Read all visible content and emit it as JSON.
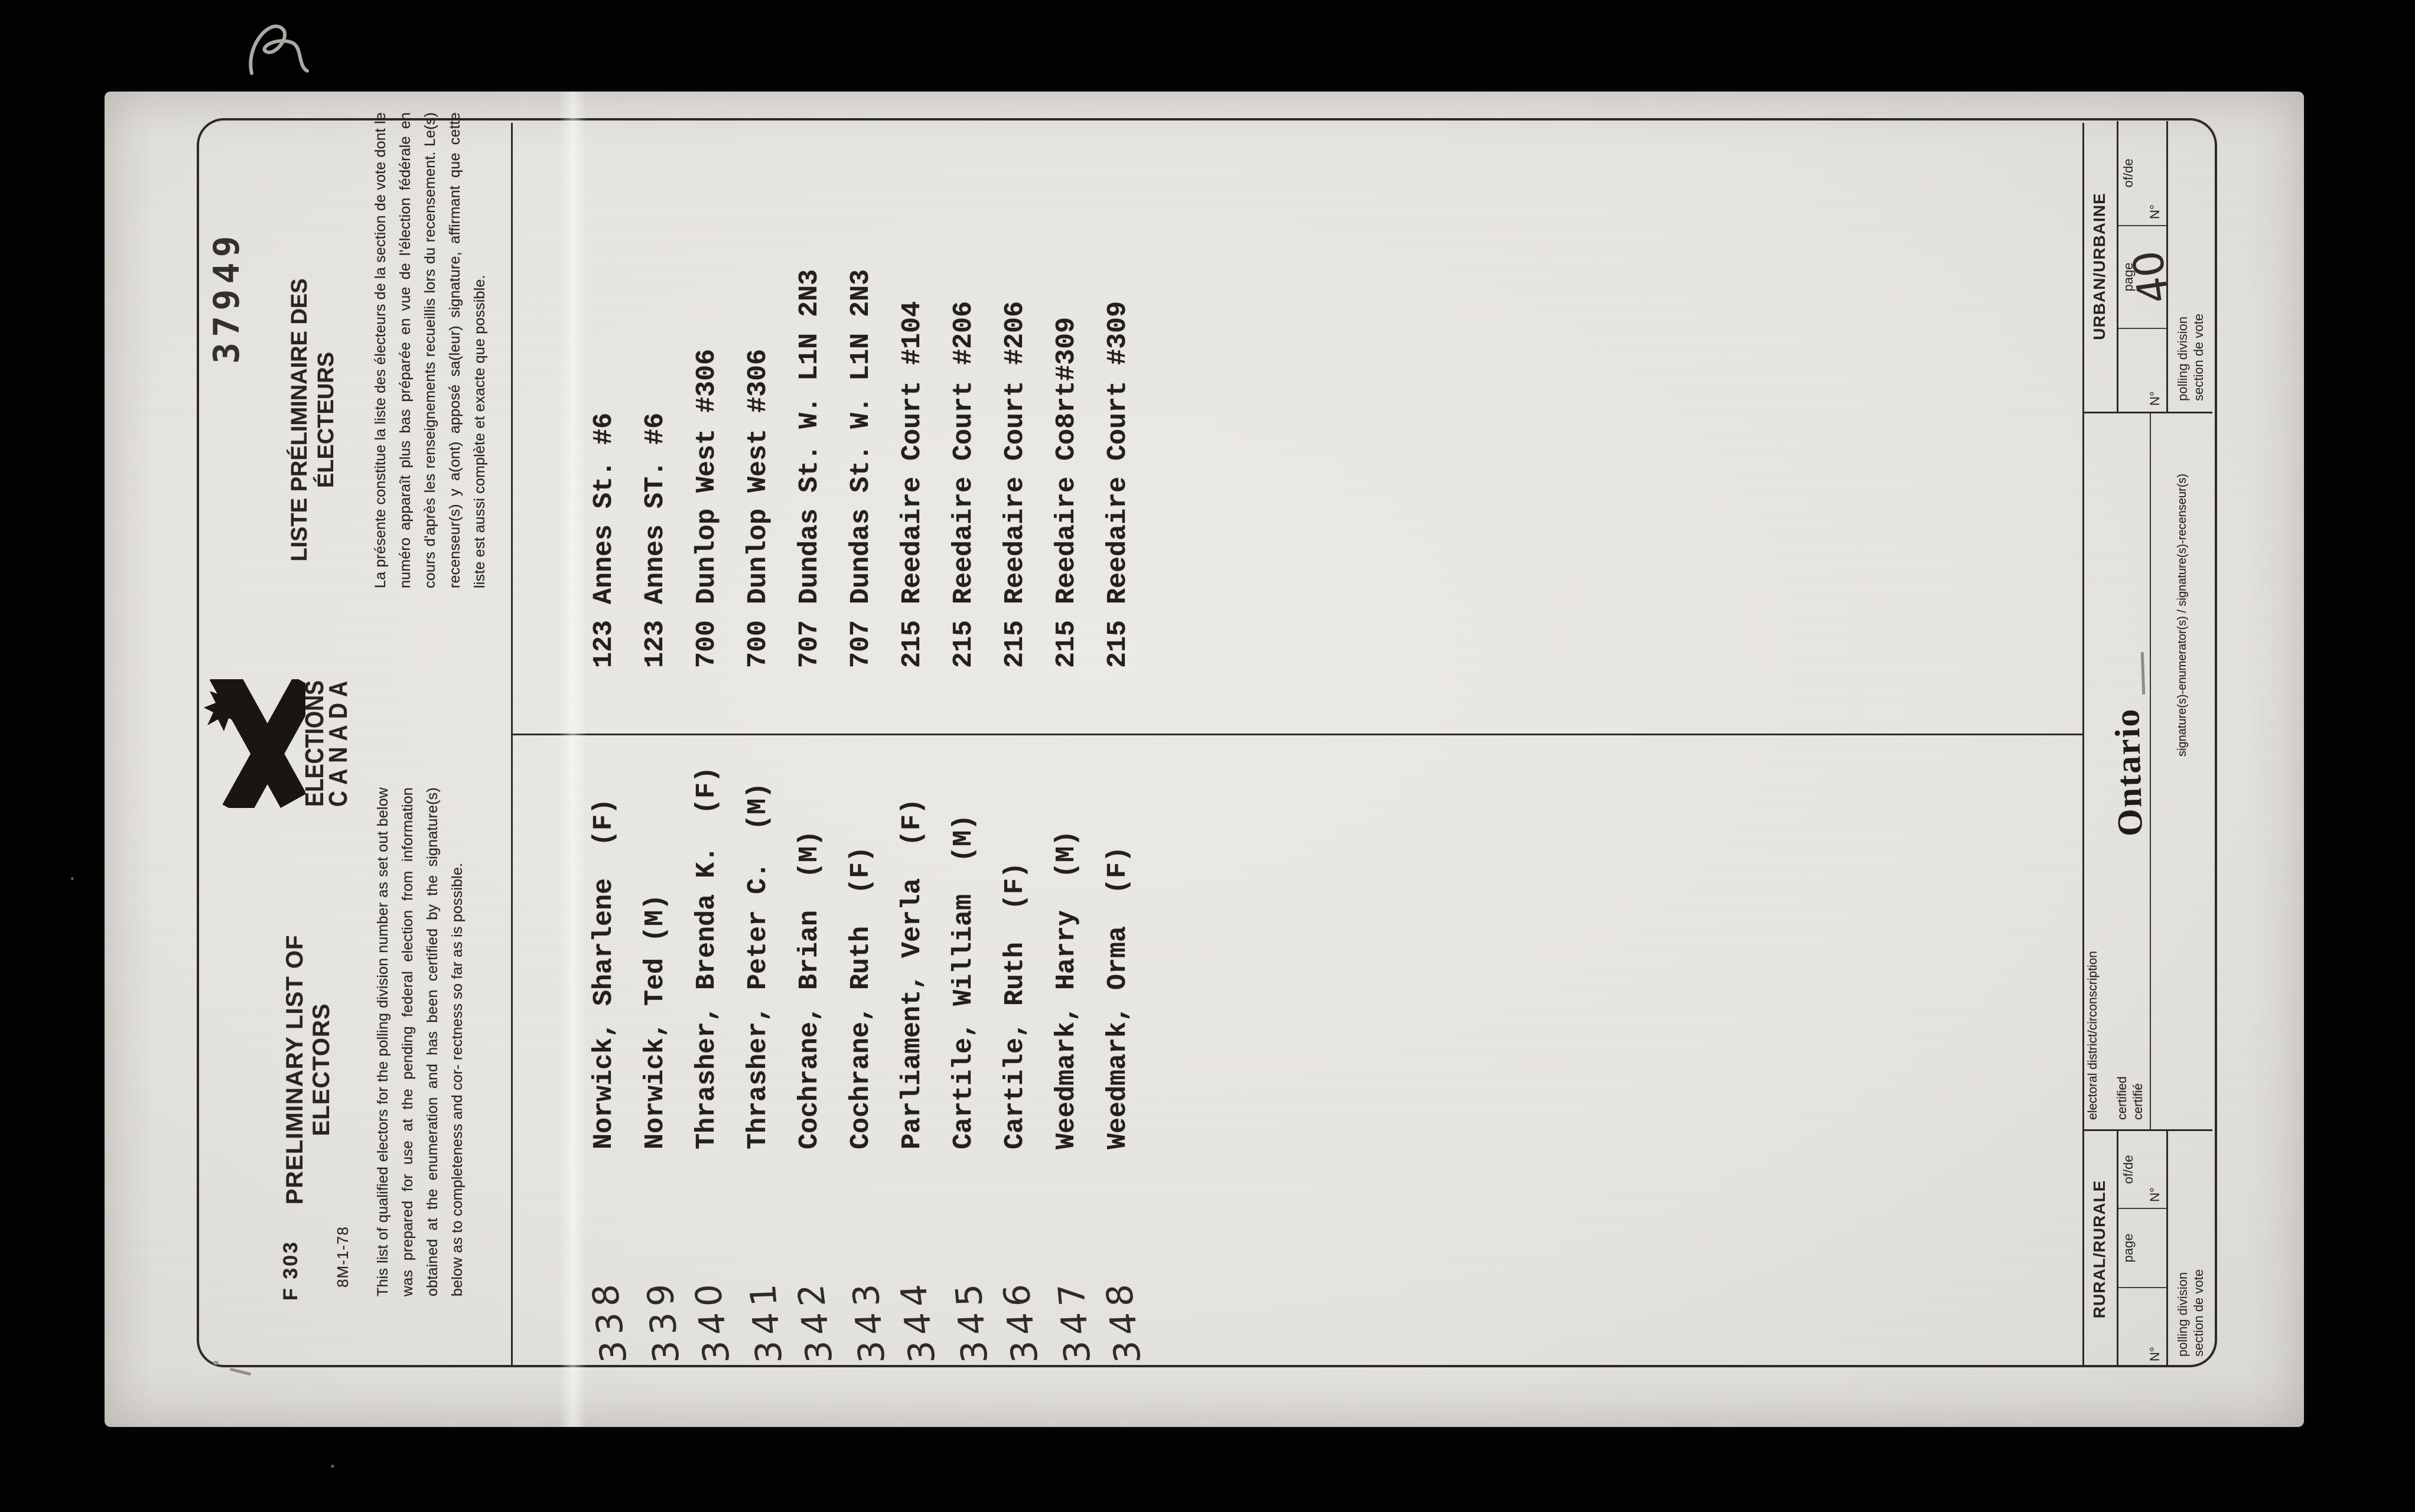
{
  "document": {
    "stamp_number": "37949",
    "header": {
      "form_number": "F 303",
      "print_code": "8M-1-78",
      "title_en": [
        "PRELIMINARY LIST OF",
        "ELECTORS"
      ],
      "title_fr": [
        "LISTE PRÉLIMINAIRE DES",
        "ÉLECTEURS"
      ],
      "paragraph_en": "This list of qualified electors for the polling division number as set out below was prepared for use at the pending federal election from information obtained at the enumeration and has been certified by the signature(s) below as to completeness and cor- rectness so far as is possible.",
      "paragraph_fr": "La présente constitue la liste des électeurs de la section de vote dont le numéro apparaît plus bas préparée en vue de l'élection fédérale en cours d'après les renseignements recueillis lors du recensement. Le(s) recenseur(s) y a(ont) apposé sa(leur) signature, affirmant que cette liste est aussi complète et exacte que possible.",
      "logo_wordmark": [
        "ELECTIONS",
        "CANADA"
      ]
    },
    "electors": [
      {
        "no": "338",
        "name": "Norwick, Sharlene  (F)",
        "address": "123 Annes St. #6"
      },
      {
        "no": "339",
        "name": "Norwick, Ted (M)",
        "address": "123 Annes ST. #6"
      },
      {
        "no": "340",
        "name": "Thrasher, Brenda K.  (F)",
        "address": "700 Dunlop West #306"
      },
      {
        "no": "341",
        "name": "Thrasher, Peter C.  (M)",
        "address": "700 Dunlop West #306"
      },
      {
        "no": "342",
        "name": "Cochrane, Brian  (M)",
        "address": "707 Dundas St. W. L1N 2N3"
      },
      {
        "no": "343",
        "name": "Cochrane, Ruth  (F)",
        "address": "707 Dundas St. W. L1N 2N3"
      },
      {
        "no": "344",
        "name": "Parliament, Verla  (F)",
        "address": "215 Reedaire Court #104"
      },
      {
        "no": "345",
        "name": "Cartile, William  (M)",
        "address": "215 Reedaire Court #206"
      },
      {
        "no": "346",
        "name": "Cartile, Ruth  (F)",
        "address": "215 Reedaire Court #206"
      },
      {
        "no": "347",
        "name": "Weedmark, Harry  (M)",
        "address": "215 Reedaire Co8rt#309"
      },
      {
        "no": "348",
        "name": "Weedmark, Orma  (F)",
        "address": "215 Reedaire Court #309"
      }
    ],
    "footer": {
      "urban_label": "URBAN/URBAINE",
      "rural_label": "RURAL/RURALE",
      "no_label": "N°",
      "page_label": "page",
      "ofde_label": "of/de",
      "polling_line1": "polling division",
      "polling_line2": "section de vote",
      "district_label": "electoral district/circonscription",
      "certified_en": "certified",
      "certified_fr": "certifié",
      "signature_label": "signature(s)-enumerator(s) / signature(s)-recenseur(s)",
      "province_stamp": "Ontario",
      "urban_page_number": "40"
    }
  },
  "colors": {
    "background": "#020202",
    "paper": "#e7e5e1",
    "ink": "#28231e",
    "line": "#2d2a26"
  }
}
